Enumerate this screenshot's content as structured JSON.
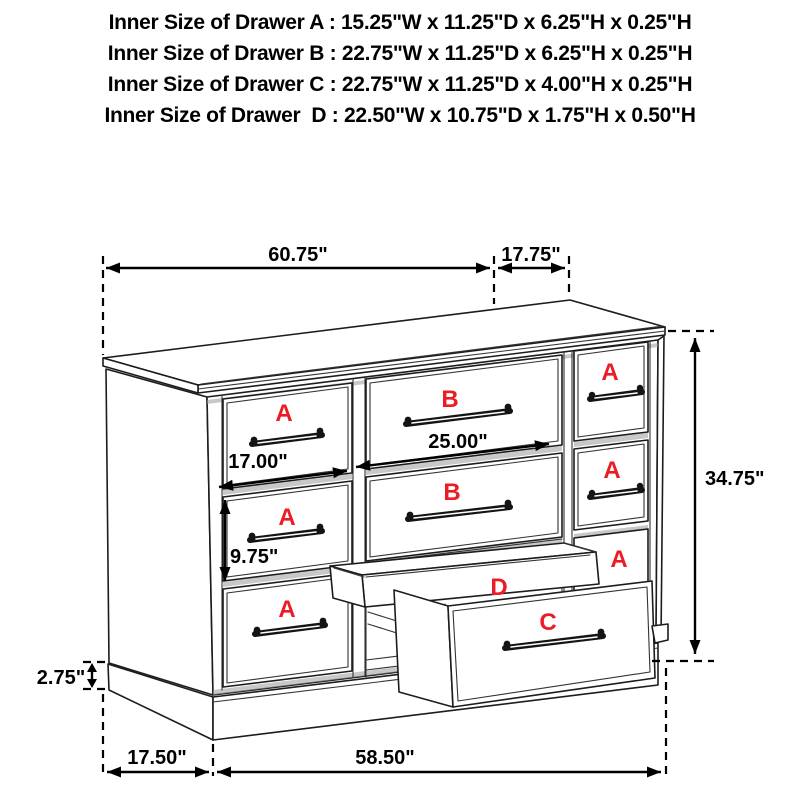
{
  "title_lines": [
    "Inner Size of Drawer A : 15.25\"W x 11.25\"D x 6.25\"H x 0.25\"H",
    "Inner Size of Drawer B : 22.75\"W x 11.25\"D x 6.25\"H x 0.25\"H",
    "Inner Size of Drawer C : 22.75\"W x 11.25\"D x 4.00\"H x 0.25\"H",
    "Inner Size of Drawer  D : 22.50\"W x 10.75\"D x 1.75\"H x 0.50\"H"
  ],
  "drawer_labels": {
    "a": "A",
    "b": "B",
    "c": "C",
    "d": "D"
  },
  "dimensions": {
    "top_width": "60.75\"",
    "top_depth": "17.75\"",
    "overall_height": "34.75\"",
    "drawer_a_width": "17.00\"",
    "drawer_b_width": "25.00\"",
    "drawer_a_height": "9.75\"",
    "base_height": "2.75\"",
    "bottom_depth": "17.50\"",
    "bottom_width": "58.50\""
  },
  "colors": {
    "label_red": "#ec1c24",
    "line": "#1c1c1c",
    "text": "#000000"
  }
}
